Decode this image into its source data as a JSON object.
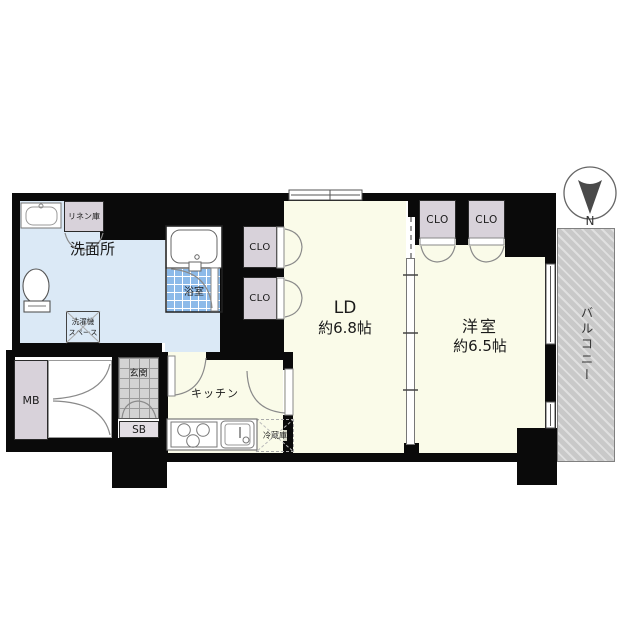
{
  "plan_type": "apartment-floor-plan",
  "labels": {
    "washroom": "洗面所",
    "bathroom": "浴室",
    "linen_closet": "リネン庫",
    "laundry_line1": "洗濯機",
    "laundry_line2": "スペース",
    "ld_name": "LD",
    "ld_size": "約6.8帖",
    "western_room": "洋室",
    "western_size": "約6.5帖",
    "kitchen": "キッチン",
    "fridge": "冷蔵庫",
    "entrance": "玄関",
    "shoe_box": "SB",
    "meter_box": "MB",
    "closet": "CLO",
    "balcony": "バルコニー",
    "compass_north": "N"
  },
  "colors": {
    "wall": "#0a0a0a",
    "floor_cream": "#fafbe9",
    "floor_blue": "#dbe9f6",
    "bath_tile_blue": "#8cbae9",
    "closet_gray": "#d8d2da",
    "balcony_gray": "#c9c9c9"
  }
}
